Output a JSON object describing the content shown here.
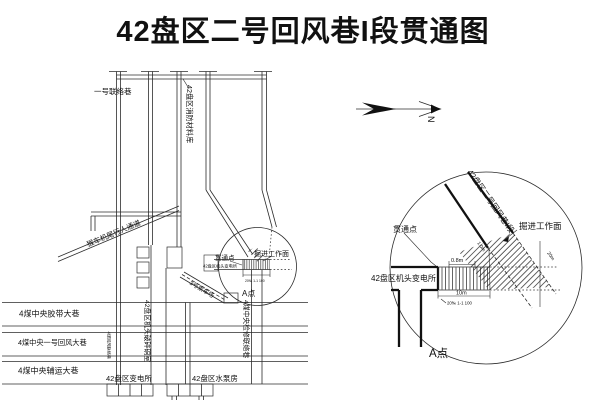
{
  "title": "42盘区二号回风巷I段贯通图",
  "compass": {
    "north": "N"
  },
  "colors": {
    "ink": "#1a1a1a",
    "background": "#ffffff"
  },
  "plan": {
    "roadways": {
      "lianluo_1": "一号联络巷",
      "xiaofang_cailiaoku": "42盘区消防材料库",
      "houche_tongdao": "猴车机尾行人通道",
      "chengchechang": "3号乘车场",
      "jiaodai_daxiang": "4煤中央胶带大巷",
      "huifeng_daxiang": "4煤中央一号回风大巷",
      "fuyun_daxiang": "4煤中央辅运大巷",
      "jitou_posui": "42盘区机头破碎硐室",
      "huifeng_lianluo": "4煤回风联络巷",
      "jianxiu_lianluo": "4煤中央检修联络巷",
      "biandiansuo": "42盘区变电所",
      "shuibengfang": "42盘区水泵房"
    }
  },
  "junction": {
    "face": "掘进工作面",
    "through_point": "贯通点",
    "substation": "42盘区机头变电所",
    "point_a": "A点",
    "roadway_segment": "42盘区二号回风巷I段",
    "dims": {
      "pillar_width": "0.8m",
      "pillar_length": "10m",
      "note": "20‰ 1-1 100",
      "clearance": "1.0m",
      "remaining": "20m"
    }
  }
}
